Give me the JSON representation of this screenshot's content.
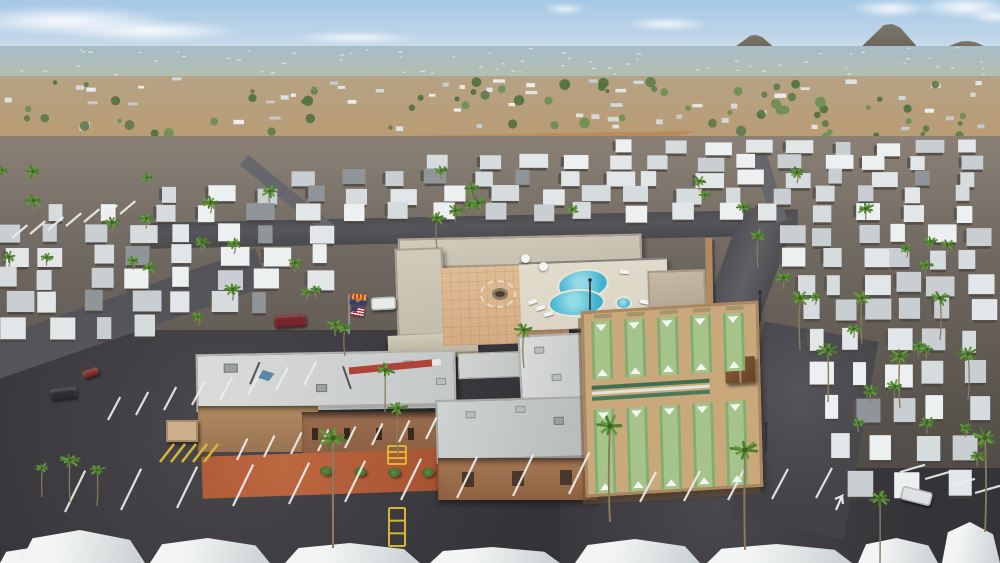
{
  "meta": {
    "title": "Aerial drone view of a desert mobile-home resort: clubhouse with swimming pool, spa and shuffleboard courts, surrounded by rows of white-roofed homes, palm trees, a large parking lot, suburban sprawl and mountain buttes on the horizon",
    "width": 1000,
    "height": 563,
    "landmarks": [
      "clubhouse-complex",
      "swimming-pool",
      "spa",
      "fire-pit-courtyard",
      "shuffleboard-courts",
      "parking-lot",
      "mobile-home-rows",
      "desert-strip",
      "suburb-horizon",
      "mountain-buttes"
    ]
  },
  "palette": {
    "sky_top": "#a6c9e6",
    "sky_mid": "#bdd4e8",
    "sky_horizon": "#dde8ee",
    "mountain": "#78705f",
    "city_far": "#a9bcc6",
    "city_near": "#b2bfb0",
    "suburb_top": "#b6a284",
    "suburb_bot": "#b99c74",
    "desert_l": "#c49464",
    "desert_d": "#b8854f",
    "road": "#56555a",
    "road_light": "#605f64",
    "lot": "#343338",
    "lot_light": "#4a484c",
    "clubroof": "#c2bcac",
    "clubroof_l": "#d0cbbb",
    "wall_tan": "#b08a62",
    "wall_brick": "#9c6e50",
    "pavers": "#d4ab82",
    "pavers_l": "#e0bd95",
    "pool_deck": "#d9d3c4",
    "pool_blue": "#3fb0cf",
    "pool_light": "#93dbe7",
    "court_tan": "#c9a87c",
    "court_green": "#a4c48c",
    "bench": "#38624342",
    "gravel": "#a85332",
    "roof_whites": [
      "#edf0f1",
      "#e2e6e8",
      "#d6dbde",
      "#c8ced2"
    ],
    "palm_greens": [
      "#4e7c30",
      "#659a3c"
    ],
    "line_white": "#eceeea",
    "line_yellow": "#d7b637",
    "curb_red": "#b04238"
  },
  "sky": {
    "mountains": [
      [
        731,
        46,
        15
      ],
      [
        858,
        62,
        26
      ],
      [
        938,
        55,
        9
      ]
    ],
    "clouds": [
      [
        -40,
        6,
        210,
        30
      ],
      [
        55,
        20,
        190,
        22
      ],
      [
        290,
        32,
        130,
        11
      ],
      [
        543,
        4,
        44,
        10
      ],
      [
        622,
        18,
        90,
        12
      ],
      [
        850,
        0,
        80,
        17
      ],
      [
        918,
        -4,
        95,
        22
      ],
      [
        968,
        10,
        55,
        13
      ]
    ]
  },
  "far": {
    "city_specks": 70,
    "suburb_houses": 55,
    "suburb_trees": 72,
    "desert_trees": 14
  },
  "park": {
    "home_rows": [
      [
        620,
        1000,
        141,
        13,
        9
      ],
      [
        430,
        1000,
        156,
        14,
        13
      ],
      [
        295,
        1000,
        171,
        15,
        16
      ],
      [
        165,
        1000,
        187,
        16,
        18
      ],
      [
        55,
        1000,
        204,
        17,
        20
      ],
      [
        0,
        352,
        224,
        18,
        8
      ],
      [
        780,
        1000,
        226,
        18,
        6
      ],
      [
        0,
        352,
        246,
        19,
        8
      ],
      [
        788,
        1000,
        250,
        19,
        6
      ],
      [
        0,
        344,
        268,
        20,
        8
      ],
      [
        797,
        1000,
        274,
        20,
        6
      ],
      [
        0,
        300,
        291,
        21,
        7
      ],
      [
        803,
        1000,
        300,
        21,
        6
      ],
      [
        0,
        180,
        316,
        22,
        4
      ],
      [
        808,
        1000,
        330,
        22,
        5
      ],
      [
        813,
        1000,
        362,
        23,
        5
      ],
      [
        820,
        1000,
        397,
        24,
        5
      ],
      [
        828,
        1000,
        434,
        25,
        4
      ],
      [
        846,
        1000,
        470,
        26,
        3
      ]
    ],
    "streets": [
      [
        244,
        160,
        330,
        230,
        13
      ],
      [
        757,
        148,
        780,
        222,
        15
      ]
    ]
  },
  "palms": {
    "large": [
      [
        333,
        438,
        548,
        13
      ],
      [
        610,
        426,
        522,
        12
      ],
      [
        745,
        450,
        550,
        12
      ],
      [
        985,
        438,
        532,
        11
      ],
      [
        880,
        498,
        563,
        9
      ],
      [
        70,
        460,
        502,
        8
      ],
      [
        97,
        470,
        506,
        7
      ],
      [
        42,
        468,
        497,
        6
      ],
      [
        385,
        370,
        412,
        8
      ],
      [
        398,
        408,
        458,
        8
      ],
      [
        524,
        330,
        368,
        8
      ],
      [
        437,
        218,
        248,
        7
      ],
      [
        800,
        298,
        350,
        9
      ],
      [
        828,
        350,
        402,
        9
      ],
      [
        862,
        298,
        344,
        8
      ],
      [
        900,
        356,
        408,
        9
      ],
      [
        940,
        298,
        340,
        8
      ],
      [
        968,
        354,
        400,
        8
      ],
      [
        758,
        236,
        268,
        7
      ],
      [
        345,
        328,
        356,
        6
      ]
    ],
    "scatter_count": 46,
    "scatter_zones": [
      [
        0,
        360,
        200,
        325
      ],
      [
        780,
        1000,
        235,
        475
      ],
      [
        0,
        1000,
        168,
        215
      ]
    ]
  },
  "amenities": {
    "shuffleboard": {
      "lanes_per_bank": 5,
      "banks": 2,
      "top_benches": 5,
      "bleacher_rows": 3,
      "gazebo": true,
      "light_poles": 3
    },
    "pool_area": {
      "pool_shape": "kidney",
      "spa": true,
      "loungers": 6,
      "umbrellas": 2
    },
    "courtyard": {
      "fire_pit": true,
      "chair_ring": true
    },
    "flags": [
      "arizona-flag",
      "united-states-flag"
    ]
  },
  "markings": {
    "stripe_rows": [
      [
        12,
        238,
        18,
        -4,
        7,
        20,
        40
      ],
      [
        108,
        420,
        28,
        -5,
        8,
        26,
        62
      ],
      [
        237,
        460,
        27,
        -3,
        8,
        24,
        64
      ],
      [
        65,
        512,
        56,
        -2,
        10,
        46,
        64
      ],
      [
        640,
        502,
        44,
        -1,
        5,
        34,
        62
      ],
      [
        900,
        472,
        25,
        7,
        4,
        26,
        16
      ]
    ],
    "yellow_ladders": [
      [
        388,
        446,
        18,
        18
      ],
      [
        389,
        508,
        16,
        38
      ]
    ],
    "yellow_hatch": [
      160,
      440,
      5,
      11
    ],
    "red_curb": [
      349,
      371,
      441,
      362
    ],
    "arrow": [
      838,
      498
    ],
    "light_poles": [
      [
        590,
        310,
        30
      ],
      [
        760,
        322,
        30
      ],
      [
        766,
        452,
        28
      ]
    ]
  },
  "vehicles": [
    {
      "name": "maroon-car",
      "x": 274,
      "y": 314,
      "w": 32,
      "h": 13,
      "color": "#76252e",
      "rot": -4
    },
    {
      "name": "white-truck",
      "x": 371,
      "y": 297,
      "w": 25,
      "h": 13,
      "color": "#e9eaea",
      "rot": -3
    },
    {
      "name": "dark-car",
      "x": 50,
      "y": 388,
      "w": 27,
      "h": 11,
      "color": "#2d2d31",
      "rot": -6
    },
    {
      "name": "white-car",
      "x": 901,
      "y": 489,
      "w": 31,
      "h": 14,
      "color": "#dde1e3",
      "rot": 14
    },
    {
      "name": "red-car",
      "x": 82,
      "y": 369,
      "w": 17,
      "h": 8,
      "color": "#7d2a24",
      "rot": -18
    }
  ],
  "foreground_roofs": [
    [
      0,
      548,
      62,
      15
    ],
    [
      20,
      530,
      125,
      33
    ],
    [
      150,
      538,
      120,
      25
    ],
    [
      285,
      543,
      135,
      20
    ],
    [
      430,
      547,
      130,
      16
    ],
    [
      575,
      539,
      125,
      24
    ],
    [
      707,
      544,
      145,
      19
    ],
    [
      858,
      538,
      80,
      25
    ],
    [
      942,
      522,
      58,
      41
    ]
  ]
}
